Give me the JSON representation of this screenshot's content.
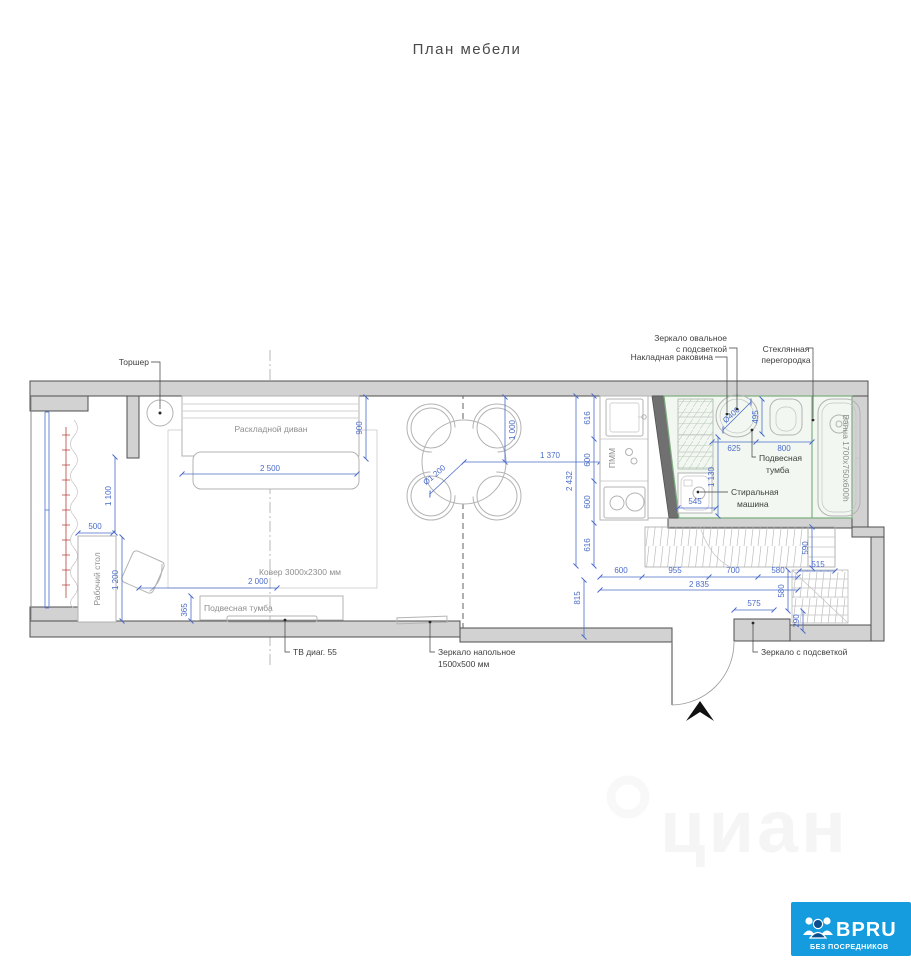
{
  "title": "План мебели",
  "labels": {
    "torsher": "Торшер",
    "sofa": "Раскладной диван",
    "desk": "Рабочий стол",
    "carpet": "Ковер 3000х2300 мм",
    "tv_cabinet": "Подвесная тумба",
    "tv": "ТВ диаг. 55",
    "floor_mirror_1": "Зеркало напольное",
    "floor_mirror_2": "1500х500 мм",
    "oval_mirror_1": "Зеркало овальное",
    "oval_mirror_2": "с подсветкой",
    "overlay_sink": "Накладная раковина",
    "glass_1": "Стеклянная",
    "glass_2": "перегородка",
    "bath_cabinet_1": "Подвесная",
    "bath_cabinet_2": "тумба",
    "washer_1": "Стиральная",
    "washer_2": "машина",
    "bath": "Ванна 1700х750х600h",
    "entry_mirror": "Зеркало с подсветкой",
    "pmm": "ПММ"
  },
  "dims": {
    "d290": "290",
    "d365": "365",
    "d495": "495",
    "d500": "500",
    "d515": "515",
    "d545": "545",
    "d575": "575",
    "d580": "580",
    "d590": "590",
    "d600": "600",
    "d616": "616",
    "d625": "625",
    "d700": "700",
    "d800": "800",
    "d815": "815",
    "d900": "900",
    "d955": "955",
    "d1000": "1 000",
    "d1100": "1 100",
    "d1130": "1 130",
    "d1200": "1 200",
    "d1370": "1 370",
    "d2000": "2 000",
    "d2432": "2 432",
    "d2500": "2 500",
    "d2835": "2 835",
    "dia400": "Ø400",
    "dia1200": "Ø1 200"
  },
  "watermark": "циан",
  "logo": {
    "name": "BPRU",
    "tagline": "БЕЗ ПОСРЕДНИКОВ"
  },
  "colors": {
    "dimension_blue": "#4a6bc9",
    "wall_gray": "#d2d2d2",
    "bathroom_green": "#7fae81",
    "radiator_red": "#b5423a",
    "logo_blue": "#149cdf"
  }
}
